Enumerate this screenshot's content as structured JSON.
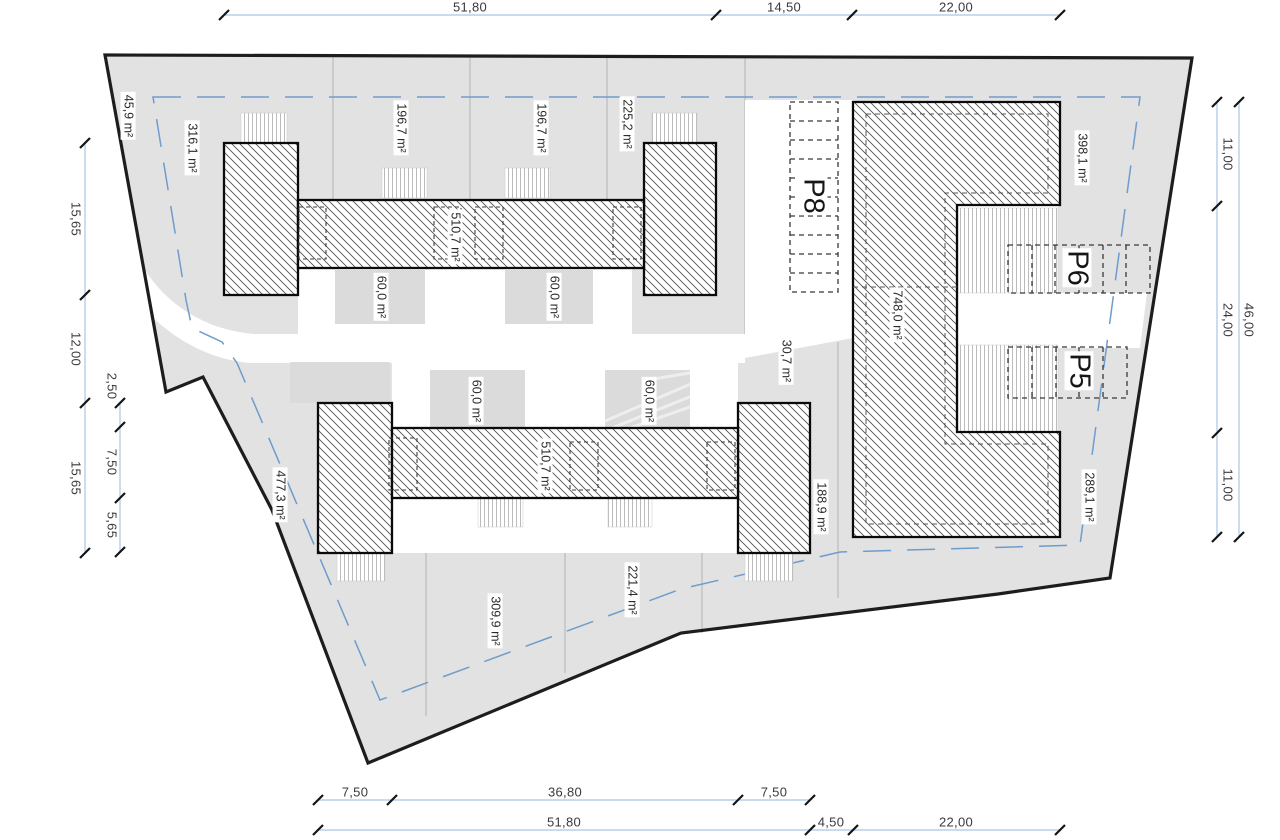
{
  "canvas": {
    "width": 1280,
    "height": 840
  },
  "colors": {
    "site_fill": "#e2e2e2",
    "boundary": "#1d1d1d",
    "setback_dashed": "#6e9ccc",
    "dimension_line": "#a9c6e2",
    "hatch": "#4a4a4a",
    "garden_fill": "#dbdbdb",
    "label_text": "#2b2b2b"
  },
  "area_labels": [
    {
      "text": "45,9 m²",
      "x": 128,
      "y": 116
    },
    {
      "text": "316,1 m²",
      "x": 192,
      "y": 148
    },
    {
      "text": "196,7 m²",
      "x": 401,
      "y": 128
    },
    {
      "text": "196,7 m²",
      "x": 541,
      "y": 128
    },
    {
      "text": "225,2 m²",
      "x": 627,
      "y": 124
    },
    {
      "text": "398,1 m²",
      "x": 1082,
      "y": 158
    },
    {
      "text": "510,7 m²",
      "x": 455,
      "y": 237
    },
    {
      "text": "510,7 m²",
      "x": 545,
      "y": 466
    },
    {
      "text": "60,0 m²",
      "x": 381,
      "y": 297
    },
    {
      "text": "60,0 m²",
      "x": 554,
      "y": 297
    },
    {
      "text": "60,0 m²",
      "x": 476,
      "y": 401
    },
    {
      "text": "60,0 m²",
      "x": 649,
      "y": 401
    },
    {
      "text": "748,0 m²",
      "x": 897,
      "y": 315
    },
    {
      "text": "30,7 m²",
      "x": 786,
      "y": 361
    },
    {
      "text": "188,9 m²",
      "x": 821,
      "y": 507
    },
    {
      "text": "289,1 m²",
      "x": 1089,
      "y": 497
    },
    {
      "text": "477,3 m²",
      "x": 280,
      "y": 495
    },
    {
      "text": "309,9 m²",
      "x": 495,
      "y": 621
    },
    {
      "text": "221,4 m²",
      "x": 632,
      "y": 590
    }
  ],
  "parking_labels": [
    {
      "text": "P8",
      "x": 813,
      "y": 196
    },
    {
      "text": "P6",
      "x": 1077,
      "y": 268
    },
    {
      "text": "P5",
      "x": 1079,
      "y": 371
    }
  ],
  "dimension_labels": [
    {
      "text": "51,80",
      "x": 470,
      "y": 7,
      "rot": false
    },
    {
      "text": "14,50",
      "x": 784,
      "y": 7,
      "rot": false
    },
    {
      "text": "22,00",
      "x": 956,
      "y": 7,
      "rot": false
    },
    {
      "text": "7,50",
      "x": 355,
      "y": 792,
      "rot": false
    },
    {
      "text": "36,80",
      "x": 565,
      "y": 792,
      "rot": false
    },
    {
      "text": "7,50",
      "x": 774,
      "y": 792,
      "rot": false
    },
    {
      "text": "51,80",
      "x": 564,
      "y": 822,
      "rot": false
    },
    {
      "text": "4,50",
      "x": 831,
      "y": 822,
      "rot": false
    },
    {
      "text": "22,00",
      "x": 956,
      "y": 822,
      "rot": false
    },
    {
      "text": "15,65",
      "x": 76,
      "y": 219,
      "rot": true
    },
    {
      "text": "12,00",
      "x": 76,
      "y": 349,
      "rot": true
    },
    {
      "text": "15,65",
      "x": 76,
      "y": 478,
      "rot": true
    },
    {
      "text": "2,50",
      "x": 112,
      "y": 386,
      "rot": true
    },
    {
      "text": "7,50",
      "x": 112,
      "y": 462,
      "rot": true
    },
    {
      "text": "5,65",
      "x": 112,
      "y": 525,
      "rot": true
    },
    {
      "text": "11,00",
      "x": 1228,
      "y": 154,
      "rot": true
    },
    {
      "text": "24,00",
      "x": 1228,
      "y": 320,
      "rot": true
    },
    {
      "text": "11,00",
      "x": 1228,
      "y": 485,
      "rot": true
    },
    {
      "text": "46,00",
      "x": 1249,
      "y": 320,
      "rot": true
    }
  ]
}
